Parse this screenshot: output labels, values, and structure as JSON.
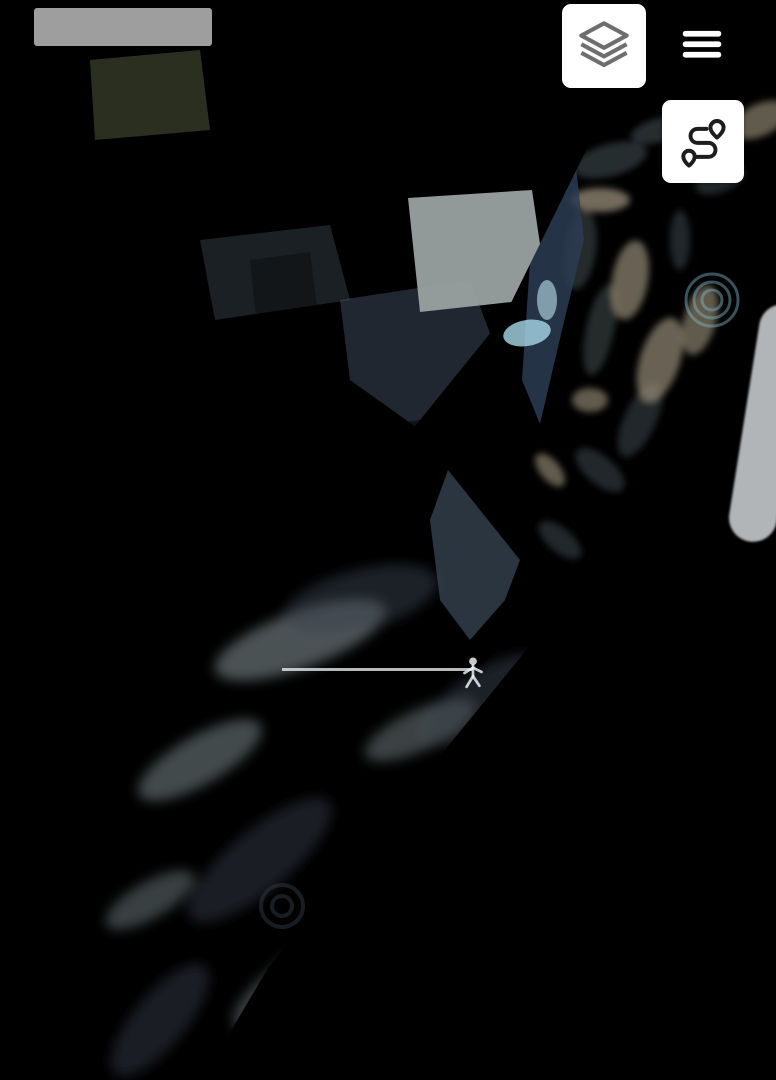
{
  "map": {
    "scale_label": "1000 m",
    "watermarks": {
      "center_brand": "PREMIER",
      "registered": "®",
      "center_subtitle": "НЕРУХОМІСТЬ",
      "copyright_left": "©",
      "agency_left": "ДЗА",
      "copyright_corner": "©",
      "agency_corner": "Л"
    }
  },
  "controls": {
    "layers_button": "layers-icon",
    "menu_button": "hamburger-menu-icon",
    "route_button": "route-icon",
    "marker": "orange-location-pin"
  },
  "theme": {
    "accent_blue": "#3C7CE5",
    "boundary_green": "#A6CE39",
    "parcel_blue": "#7CC0E8",
    "pin_orange": "#F9A91E",
    "sea": "#55626B",
    "lagoon": "#5A6A76",
    "sand": "#D6D2C4",
    "field": "#8D99A4",
    "island": "#6B6757",
    "nodata": "#F7F8F8",
    "icon_gray": "#6E6E6E",
    "ink": "#3C4043"
  }
}
